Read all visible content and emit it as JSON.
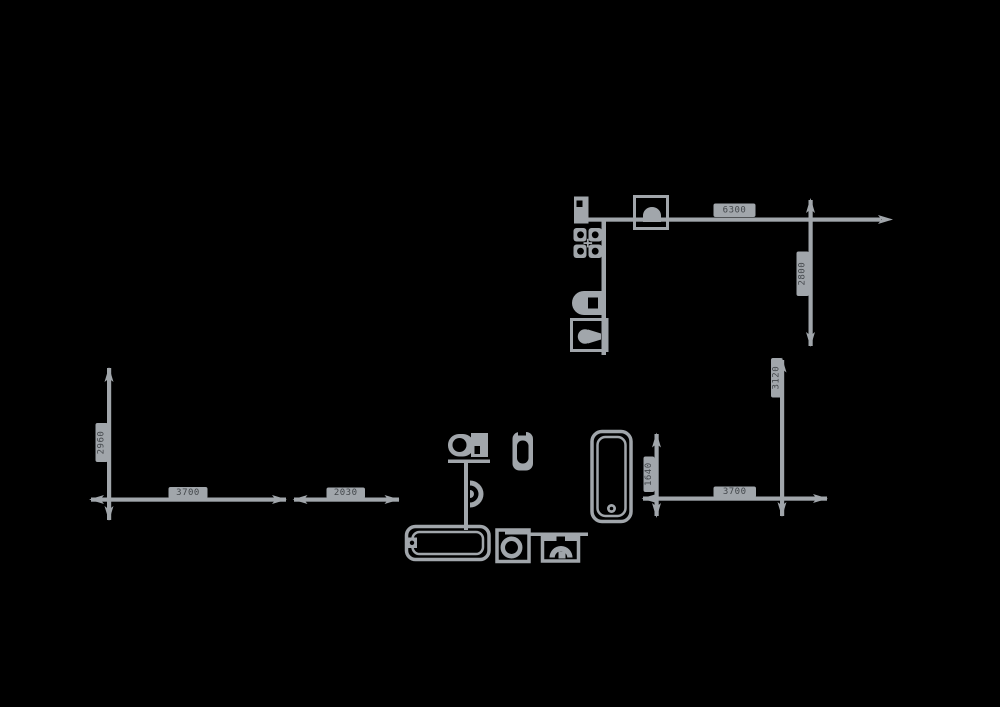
{
  "canvas": {
    "background_color": "#000000",
    "drawing_color": "#a1a6ab",
    "label_badge_color": "#a1a6ab",
    "label_text_color": "#43474b"
  },
  "floorplan": {
    "kitchen": {
      "fixtures": [
        "base-cabinet",
        "gas-hob-4-burner",
        "kitchen-sink-unit",
        "boiler",
        "lamp-cabinet"
      ]
    },
    "bathroom": {
      "fixtures": [
        "toilet",
        "bidet",
        "pedestal-sink",
        "bathtub-horizontal",
        "washing-machine",
        "wash-basin",
        "bathtub-vertical"
      ]
    },
    "dimensions": [
      {
        "id": "kitchen-wall-width",
        "value": "6300",
        "orientation": "horizontal"
      },
      {
        "id": "kitchen-depth",
        "value": "2800",
        "orientation": "vertical"
      },
      {
        "id": "right-lower-height",
        "value": "3120",
        "orientation": "vertical"
      },
      {
        "id": "left-room-height",
        "value": "2960",
        "orientation": "vertical"
      },
      {
        "id": "left-room-width",
        "value": "3700",
        "orientation": "horizontal"
      },
      {
        "id": "left-room-width-2",
        "value": "2030",
        "orientation": "horizontal"
      },
      {
        "id": "bathroom-inner-height",
        "value": "1640",
        "orientation": "vertical"
      },
      {
        "id": "bathroom-width",
        "value": "3700",
        "orientation": "horizontal"
      }
    ]
  }
}
